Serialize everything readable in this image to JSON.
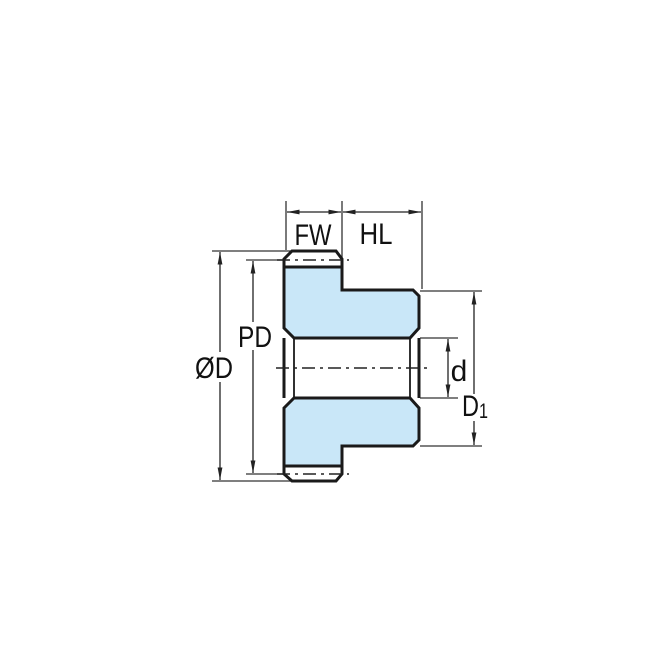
{
  "diagram": {
    "kind": "technical-dimension-drawing",
    "subject": "spur-gear-side-section",
    "colors": {
      "background": "#FFFFFF",
      "part_fill": "#C9E7F8",
      "outline": "#1A1A1A",
      "dimension_lines": "#333333",
      "text": "#111111"
    },
    "labels": {
      "face_width": "FW",
      "hub_length": "HL",
      "pitch_diameter": "PD",
      "outside_diameter": "ØD",
      "bore_diameter": "d",
      "hub_diameter_main": "D",
      "hub_diameter_sub": "1"
    }
  }
}
